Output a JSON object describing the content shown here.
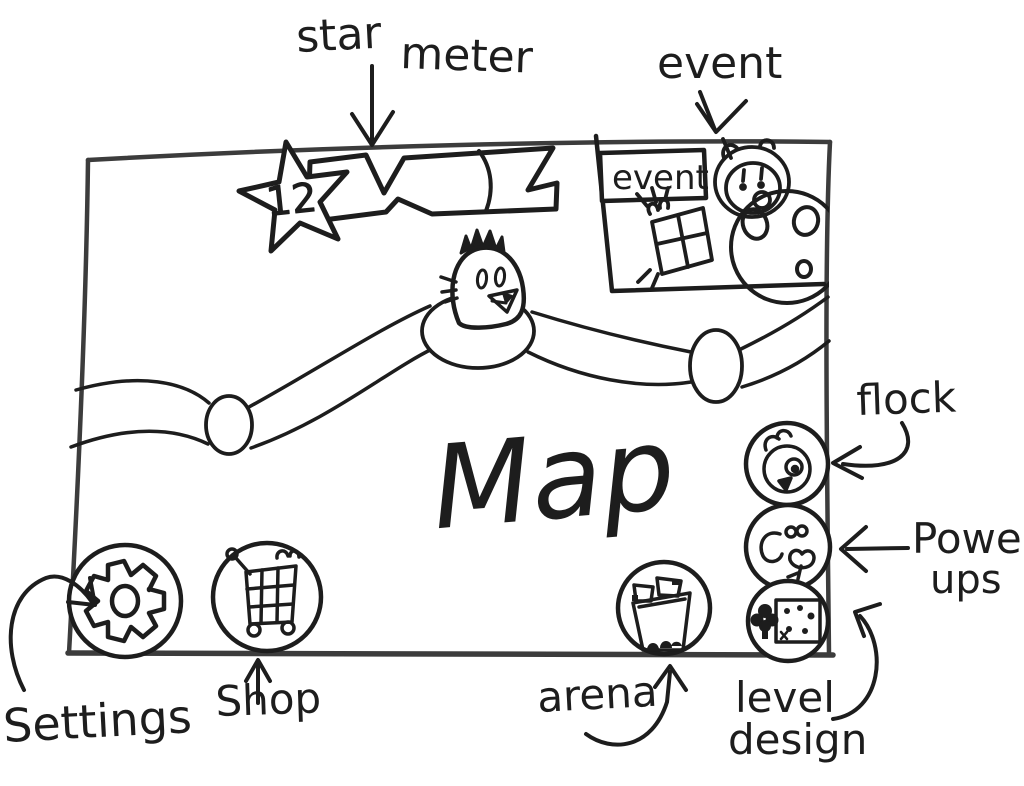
{
  "colors": {
    "ink": "#1d1d1d",
    "frame": "#3c3c3c",
    "background": "#ffffff"
  },
  "map": {
    "title": "Map",
    "star_meter": {
      "annotation_word1": "star",
      "annotation_word2": "meter",
      "star_count": "12",
      "icon": "star-icon"
    },
    "event_panel": {
      "annotation": "event",
      "tab_label": "event",
      "icons": [
        "pig-icon",
        "gift-icon",
        "planet-icon"
      ]
    },
    "buttons": {
      "settings": {
        "annotation": "Settings",
        "icon": "gear-icon"
      },
      "shop": {
        "annotation": "Shop",
        "icon": "cart-icon"
      },
      "arena": {
        "annotation": "arena",
        "icon": "stadium-icon"
      },
      "flock": {
        "annotation": "flock",
        "icon": "bird-icon"
      },
      "power_ups": {
        "annotation_line1": "Power",
        "annotation_line2": "ups",
        "icon": "powerup-icon"
      },
      "level_design": {
        "annotation_line1": "level",
        "annotation_line2": "design",
        "icon": "level-tile-icon"
      }
    }
  }
}
